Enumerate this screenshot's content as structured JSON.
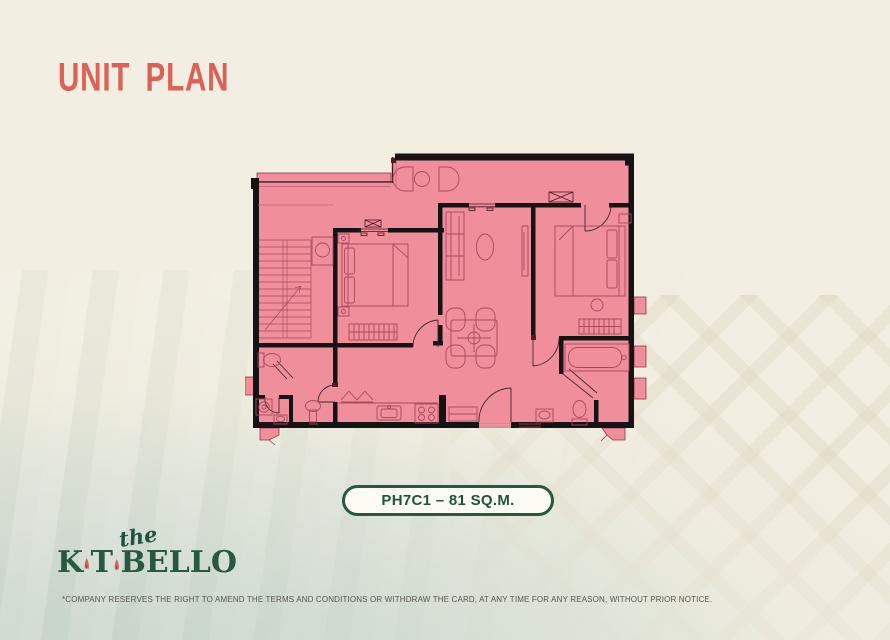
{
  "header": {
    "title": "UNIT PLAN",
    "title_color": "#DD6156"
  },
  "unit": {
    "label": "PH7C1 – 81 SQ.M.",
    "code": "PH7C1",
    "area": "81 SQ.M."
  },
  "floor_plan": {
    "description": "Pink two-bedroom penthouse floor plan with foyer, stairs, living-dining area, kitchen, two bathrooms, balcony ledges and furniture symbols",
    "fill_color": "#F18E9C",
    "wall_color": "#141414",
    "furniture_line_color": "#A8495C"
  },
  "logo": {
    "script": "the",
    "k": "K",
    "t": "T",
    "bello": "BELLO",
    "brand": "The Katabello",
    "green": "#27593F",
    "sail_color": "#E0604E"
  },
  "footer": {
    "disclaimer": "*COMPANY RESERVES THE RIGHT TO AMEND THE TERMS AND CONDITIONS OR WITHDRAW THE CARD, AT ANY TIME FOR ANY REASON, WITHOUT PRIOR NOTICE."
  },
  "colors": {
    "background": "#F2EEE1",
    "water": "#CFDACF",
    "pill_border": "#27593F",
    "pill_text": "#1D5340"
  }
}
